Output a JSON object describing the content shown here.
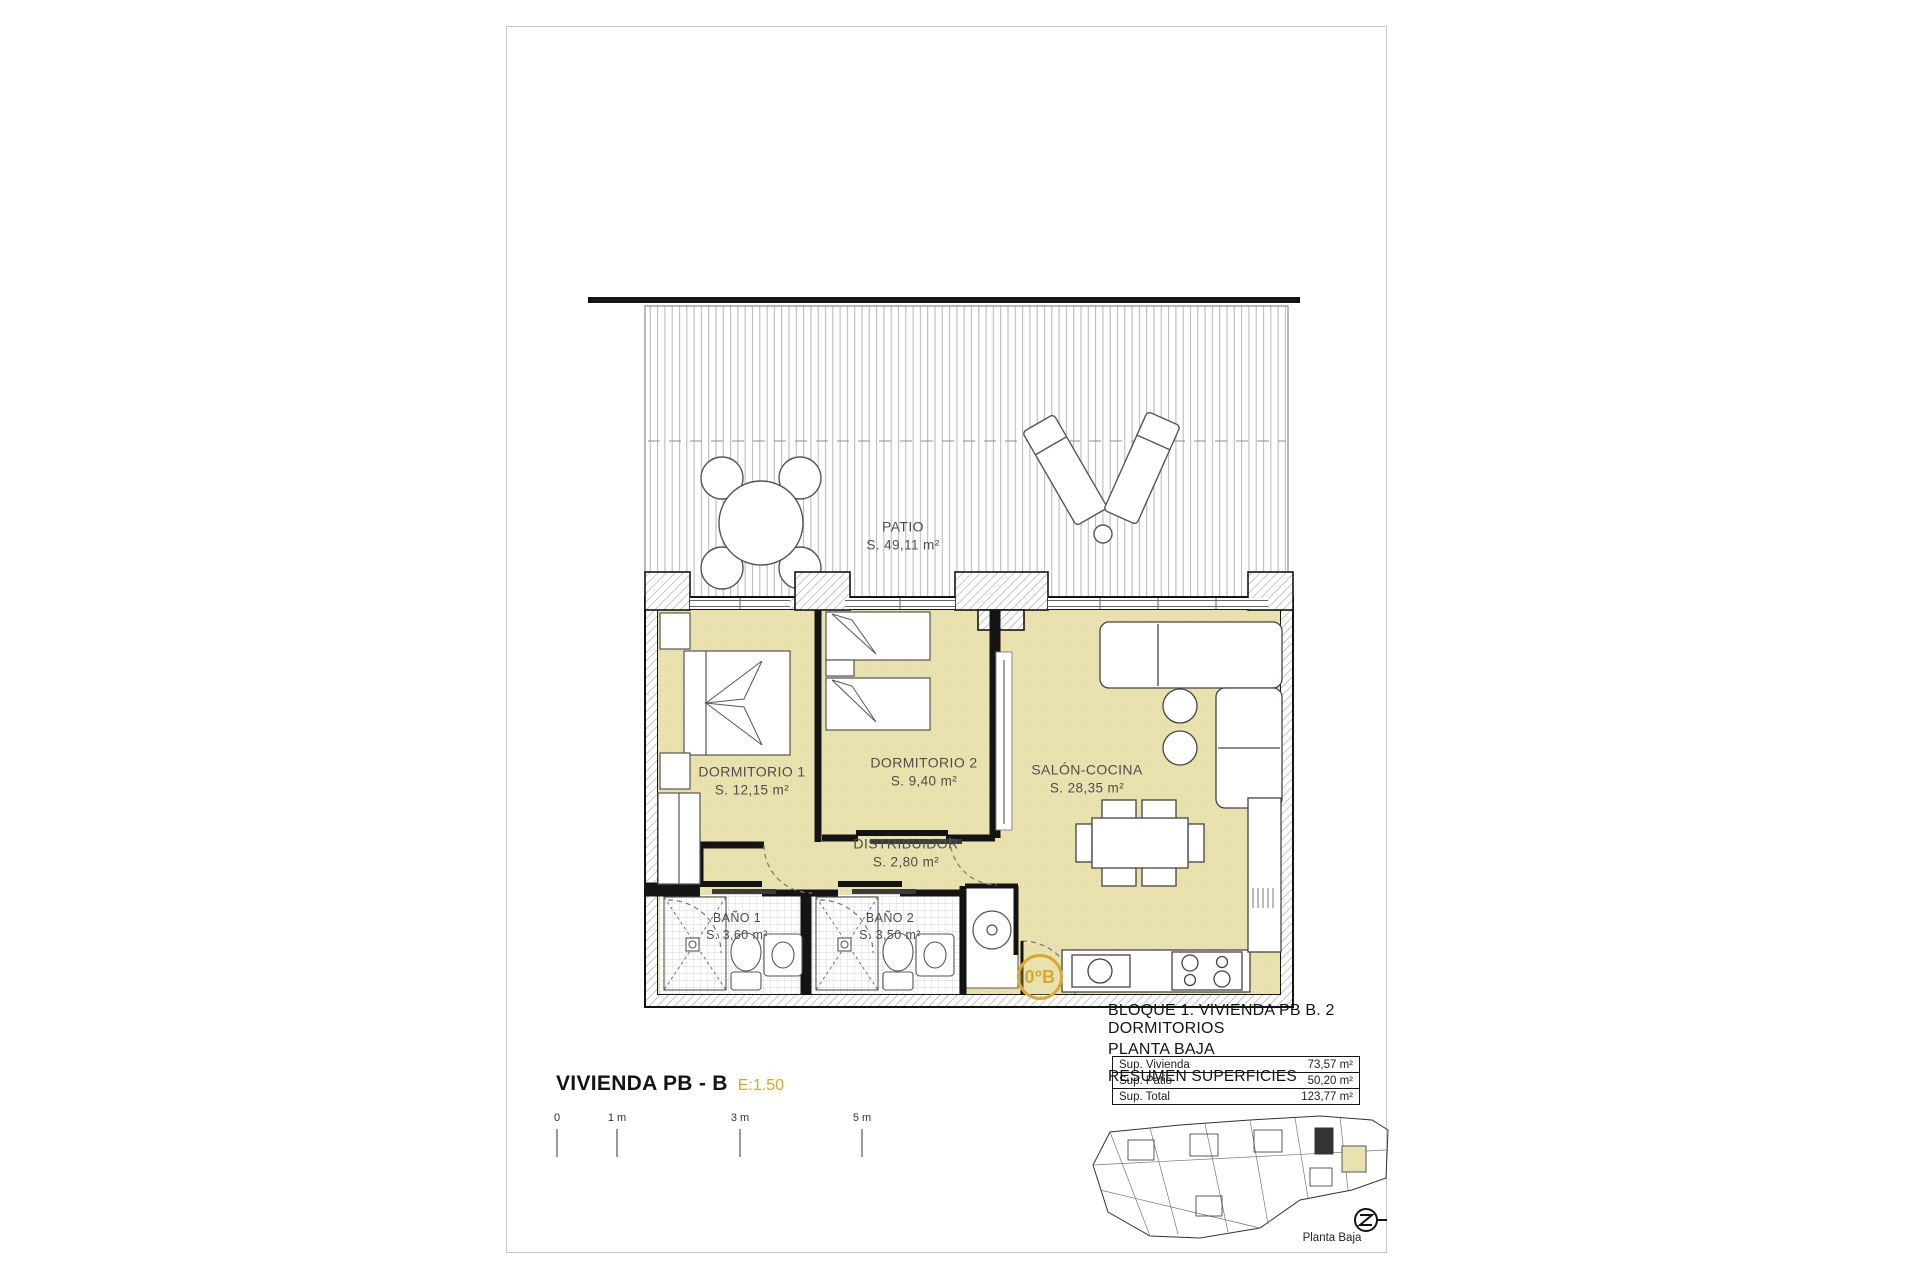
{
  "rooms": {
    "patio": {
      "name": "PATIO",
      "area": "S. 49,11 m²"
    },
    "dormitorio1": {
      "name": "DORMITORIO 1",
      "area": "S. 12,15 m²"
    },
    "dormitorio2": {
      "name": "DORMITORIO 2",
      "area": "S. 9,40 m²"
    },
    "salon_cocina": {
      "name": "SALÓN-COCINA",
      "area": "S. 28,35 m²"
    },
    "distribuidor": {
      "name": "DISTRIBUIDOR",
      "area": "S. 2,80 m²"
    },
    "bano1": {
      "name": "BAÑO 1",
      "area": "S. 3,60 m²"
    },
    "bano2": {
      "name": "BAÑO 2",
      "area": "S. 3,50 m²"
    }
  },
  "entry": {
    "label": "0ºB"
  },
  "title_block": {
    "project_line": "BLOQUE 1. VIVIENDA PB B. 2 DORMITORIOS",
    "floor_line": "PLANTA BAJA",
    "summary_heading": "RESUMEN SUPERFICIES",
    "surface_table": {
      "rows": [
        {
          "label": "Sup. Vivienda",
          "value": "73,57 m²"
        },
        {
          "label": "Sup. Patio",
          "value": "50,20 m²"
        },
        {
          "label": "Sup. Total",
          "value": "123,77 m²"
        }
      ]
    }
  },
  "plan_caption": {
    "title": "VIVIENDA PB - B",
    "scale": "E:1.50"
  },
  "scale_bar": {
    "ticks": [
      "0",
      "1 m",
      "3 m",
      "5 m"
    ]
  },
  "key_plan": {
    "caption": "Planta Baja"
  },
  "colors": {
    "room_fill": "#e9e2ae",
    "accent_gold": "#D9A733",
    "wall": "#141414",
    "label_text": "#4d4d4d"
  }
}
